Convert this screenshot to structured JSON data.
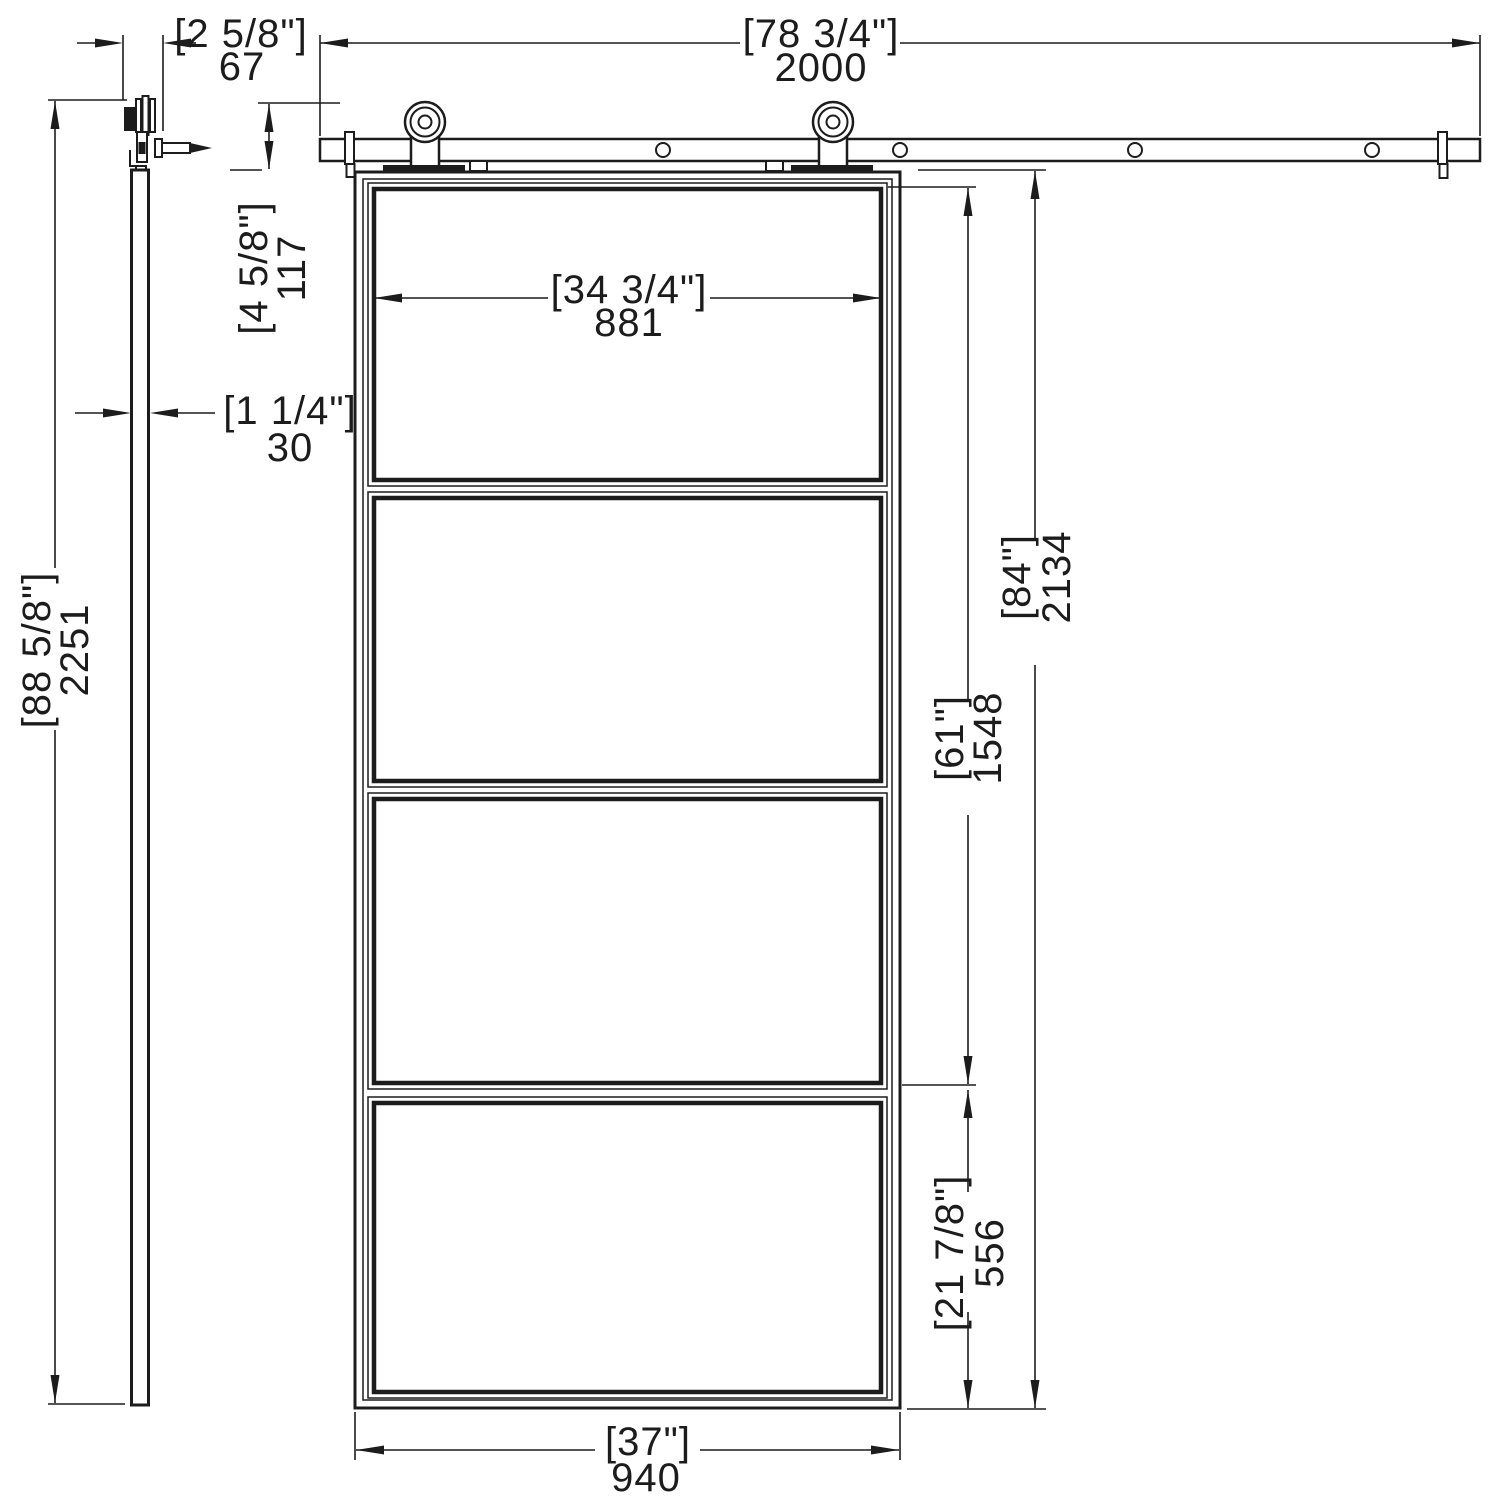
{
  "title": "Sliding glass barn door dimension drawing",
  "colors": {
    "line": "#1c1c1c",
    "background": "#ffffff"
  },
  "dimensions": {
    "hardware_offset": {
      "inches": "[2 5/8\"]",
      "mm": "67"
    },
    "track_length": {
      "inches": "[78 3/4\"]",
      "mm": "2000"
    },
    "track_to_door_top": {
      "inches": "[4 5/8\"]",
      "mm": "117"
    },
    "glass_width": {
      "inches": "[34 3/4\"]",
      "mm": "881"
    },
    "door_thickness": {
      "inches": "[1 1/4\"]",
      "mm": "30"
    },
    "overall_height": {
      "inches": "[88 5/8\"]",
      "mm": "2251"
    },
    "glass_section_height": {
      "inches": "[61\"]",
      "mm": "1548"
    },
    "door_height": {
      "inches": "[84\"]",
      "mm": "2134"
    },
    "bottom_section_height": {
      "inches": "[21 7/8\"]",
      "mm": "556"
    },
    "door_width": {
      "inches": "[37\"]",
      "mm": "940"
    }
  }
}
